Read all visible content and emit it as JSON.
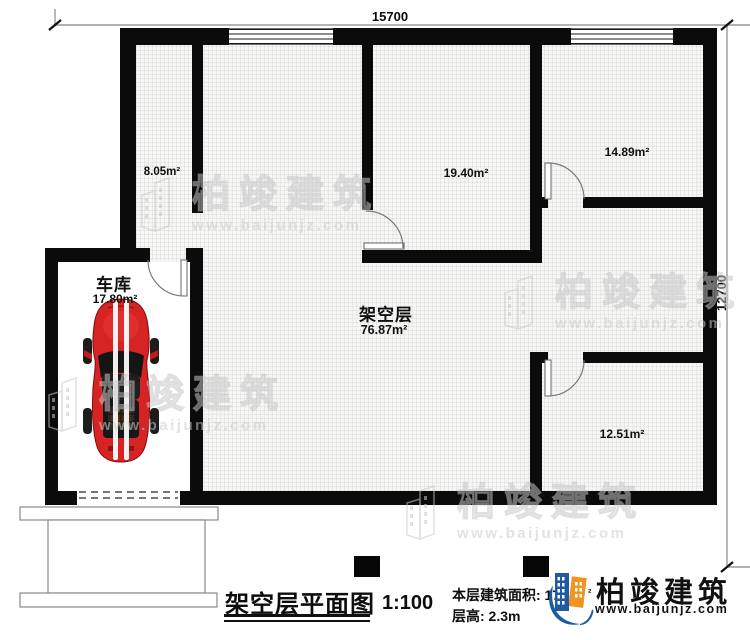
{
  "plan": {
    "dim_top": "15700",
    "dim_right": "12700",
    "rooms": {
      "room_a": {
        "area": "8.05m²"
      },
      "room_b": {
        "area": "19.40m²"
      },
      "room_c": {
        "area": "14.89m²"
      },
      "room_d": {
        "area": "12.51m²"
      },
      "garage": {
        "name": "车库",
        "area": "17.80m²"
      },
      "stilt_floor": {
        "name": "架空层",
        "area": "76.87m²"
      }
    }
  },
  "title_block": {
    "title": "架空层平面图",
    "scale": "1:100",
    "floor_area_label": "本层建筑面积: 17",
    "floor_area_sup": "²",
    "floor_height": "层高: 2.3m"
  },
  "logo": {
    "brand": "柏竣建筑",
    "website": "www.baijunjz.com"
  },
  "watermark": {
    "brand": "柏竣建筑",
    "website": "www.baijunjz.com"
  }
}
